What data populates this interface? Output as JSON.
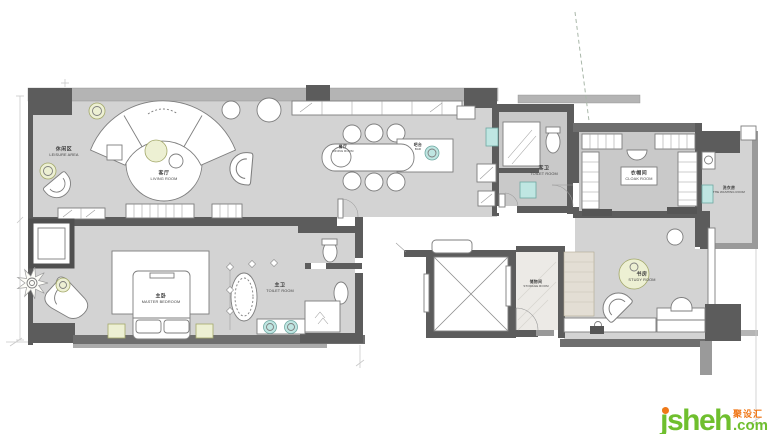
{
  "rooms": {
    "leisure": {
      "zh": "休闲区",
      "en": "LEISURE AREA"
    },
    "living": {
      "zh": "客厅",
      "en": "LIVING ROOM"
    },
    "dining": {
      "zh": "餐厅",
      "en": "DINING ROOM"
    },
    "bar": {
      "zh": "吧台",
      "en": "BAR"
    },
    "toilet_guest": {
      "zh": "客卫",
      "en": "TOILET ROOM"
    },
    "cloak": {
      "zh": "衣帽间",
      "en": "CLOAK ROOM"
    },
    "washing": {
      "zh": "洗衣房",
      "en": "THE WASHING ROOM"
    },
    "master": {
      "zh": "主卧",
      "en": "MASTER BEDROOM"
    },
    "toilet_master": {
      "zh": "主卫",
      "en": "TOILET ROOM"
    },
    "storage": {
      "zh": "储物间",
      "en": "STORAGE ROOM"
    },
    "study": {
      "zh": "书房",
      "en": "STUDY ROOM"
    }
  },
  "watermark": {
    "name": "jsheh",
    "tld": ".com",
    "tag": "聚设汇",
    "green": "#6fbf2e",
    "orange": "#f07818"
  },
  "palette": {
    "floor": "#d3d3d3",
    "floor_dark": "#c9c9c9",
    "wall": "#5c5c5c",
    "window_band": "#b4b4b4",
    "fixture_teal": "#bfe6e2",
    "accent_green": "#edf0d3"
  }
}
